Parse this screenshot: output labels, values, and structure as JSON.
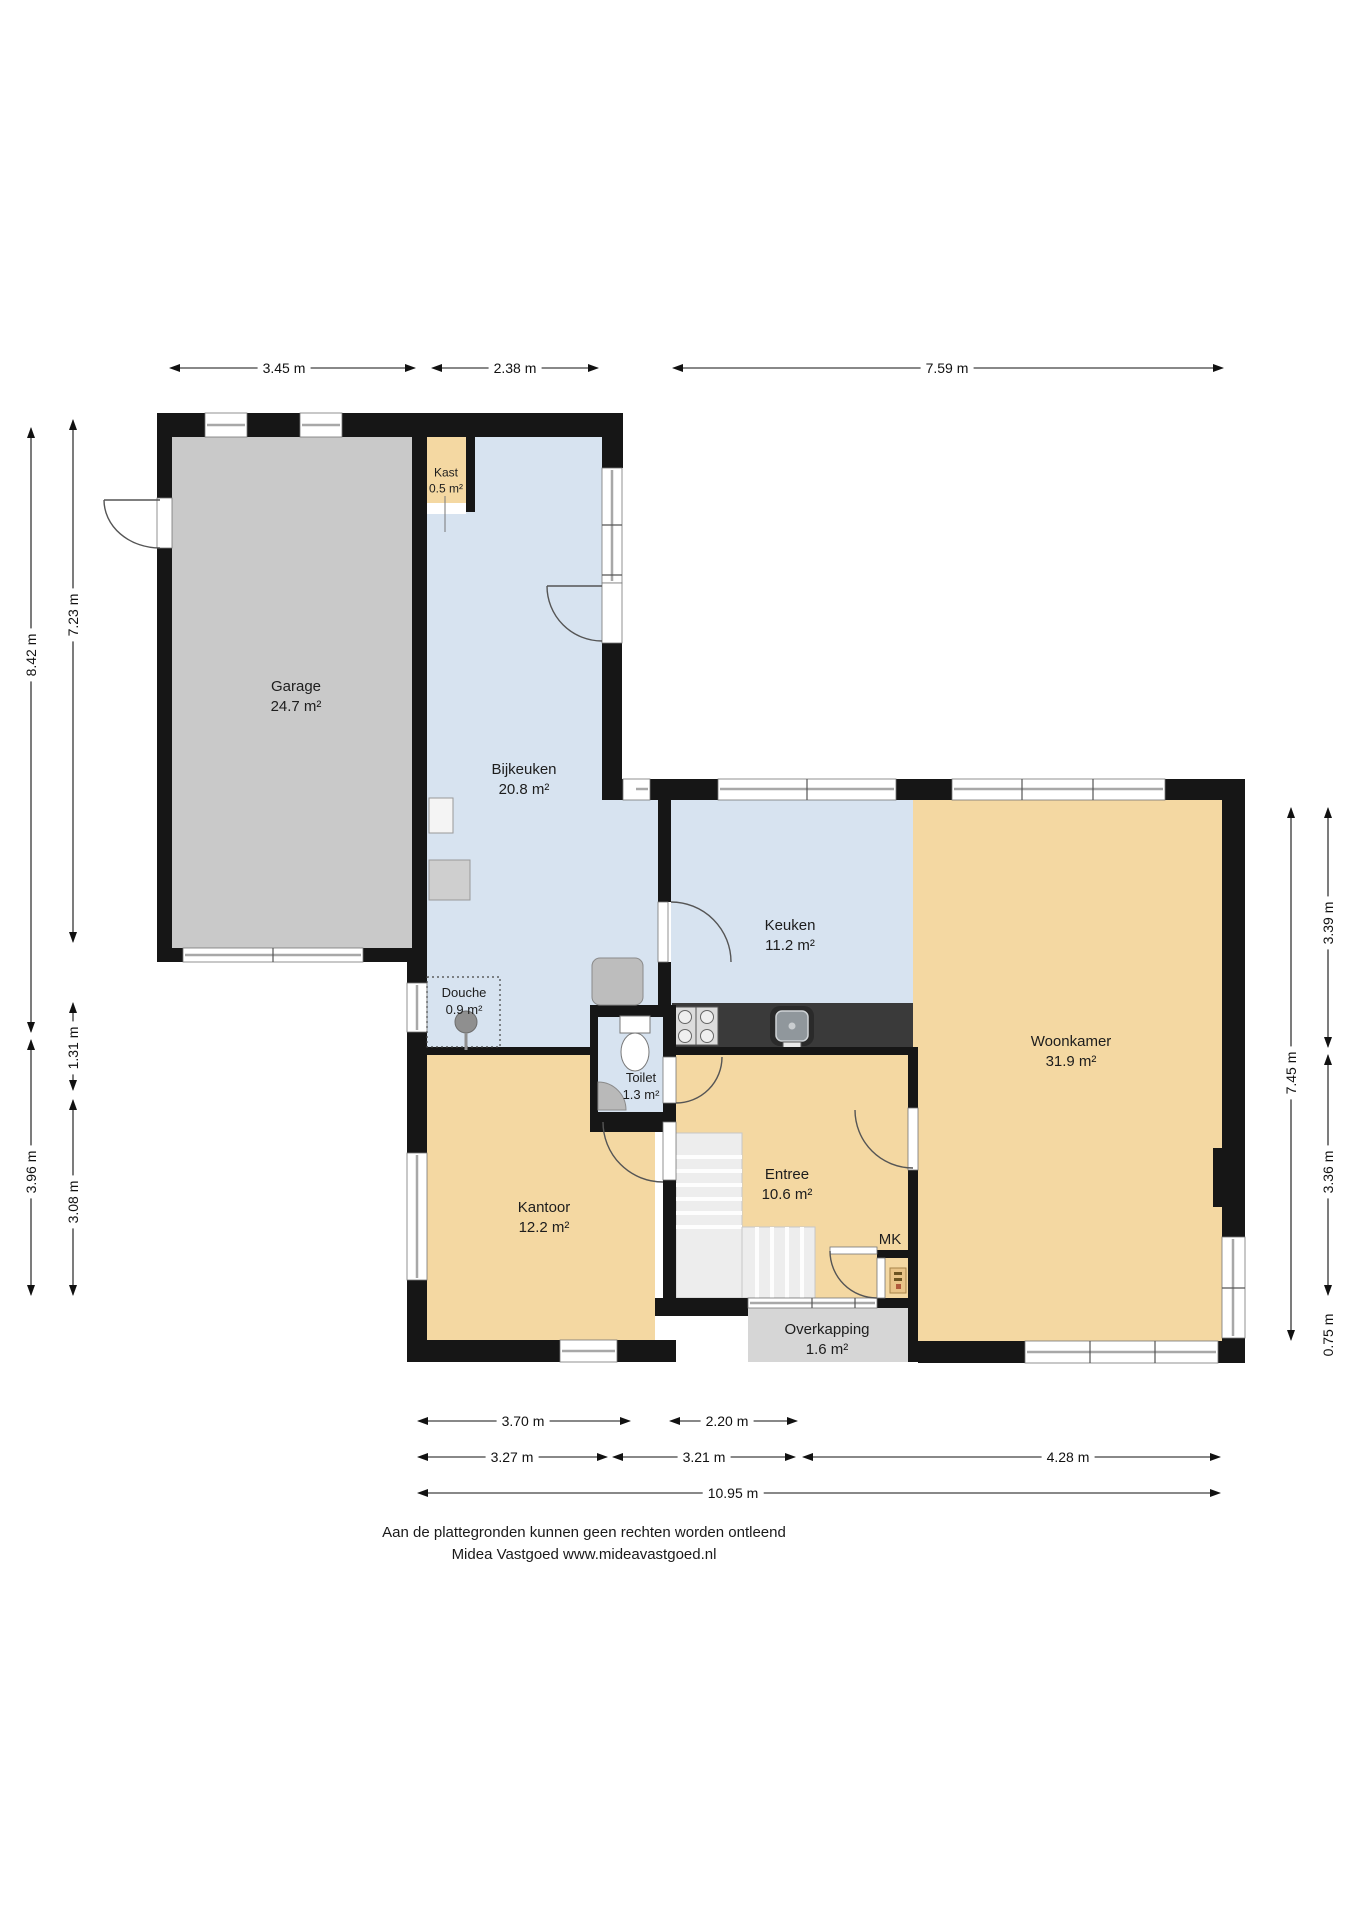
{
  "colors": {
    "room_orange": "#f4d8a2",
    "room_blue": "#d7e3f0",
    "room_gray": "#c9c9c9",
    "porch_gray": "#d6d6d6",
    "wall_black": "#161616"
  },
  "rooms": [
    {
      "id": "garage",
      "label": "Garage",
      "area": "24.7 m²"
    },
    {
      "id": "bijkeuken",
      "label": "Bijkeuken",
      "area": "20.8 m²"
    },
    {
      "id": "kast",
      "label": "Kast",
      "area": "0.5 m²"
    },
    {
      "id": "douche",
      "label": "Douche",
      "area": "0.9 m²"
    },
    {
      "id": "keuken",
      "label": "Keuken",
      "area": "11.2 m²"
    },
    {
      "id": "woonkamer",
      "label": "Woonkamer",
      "area": "31.9 m²"
    },
    {
      "id": "toilet",
      "label": "Toilet",
      "area": "1.3 m²"
    },
    {
      "id": "entree",
      "label": "Entree",
      "area": "10.6 m²"
    },
    {
      "id": "kantoor",
      "label": "Kantoor",
      "area": "12.2 m²"
    },
    {
      "id": "mk",
      "label": "MK",
      "area": ""
    },
    {
      "id": "overkapping",
      "label": "Overkapping",
      "area": "1.6 m²"
    }
  ],
  "dimensions": {
    "top": [
      "3.45 m",
      "2.38 m",
      "7.59 m"
    ],
    "left": [
      "8.42 m",
      "7.23 m",
      "1.31 m",
      "3.96 m",
      "3.08 m"
    ],
    "right": [
      "3.39 m",
      "7.45 m",
      "3.36 m",
      "0.75 m"
    ],
    "bottom": [
      "3.70 m",
      "2.20 m",
      "3.27 m",
      "3.21 m",
      "4.28 m",
      "10.95 m"
    ]
  },
  "footer": {
    "line1": "Aan de plattegronden kunnen geen rechten worden ontleend",
    "line2": "Midea Vastgoed www.mideavastgoed.nl"
  }
}
